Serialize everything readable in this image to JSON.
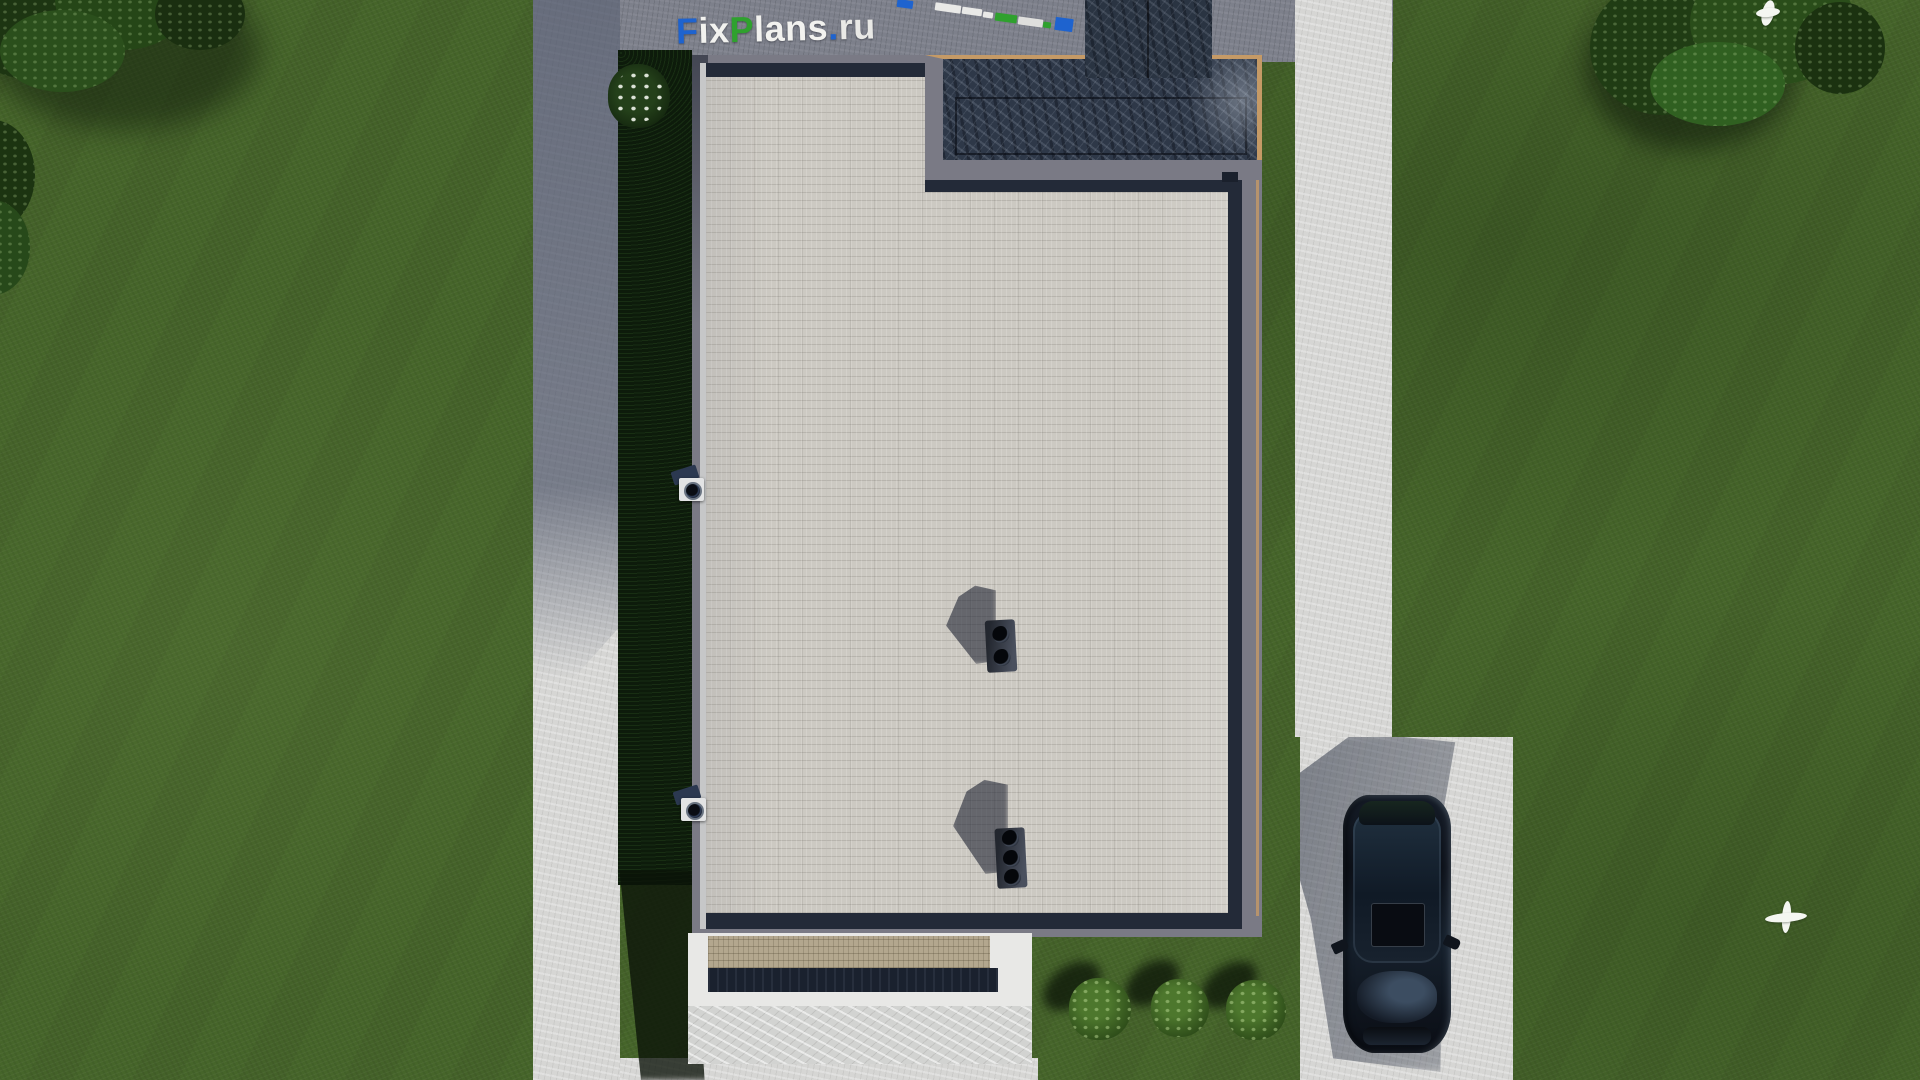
{
  "watermark": {
    "text": "FixPlans.ru",
    "segments": [
      {
        "char": "F",
        "color": "#1e63cf"
      },
      {
        "char": "i",
        "color": "#f2f2ef"
      },
      {
        "char": "x",
        "color": "#f2f2ef"
      },
      {
        "char": "P",
        "color": "#2fa12e"
      },
      {
        "char": "l",
        "color": "#f2f2ef"
      },
      {
        "char": "a",
        "color": "#f2f2ef"
      },
      {
        "char": "n",
        "color": "#f2f2ef"
      },
      {
        "char": "s",
        "color": "#f2f2ef"
      },
      {
        "char": ".",
        "color": "#1e63cf"
      },
      {
        "char": "r",
        "color": "#e9e9e6"
      },
      {
        "char": "u",
        "color": "#e9e9e6"
      }
    ],
    "fragments": [
      {
        "x": 897,
        "y": 0,
        "w": 16,
        "h": 8,
        "color": "#1e63cf"
      },
      {
        "x": 935,
        "y": 4,
        "w": 26,
        "h": 8,
        "color": "#e9e9e7"
      },
      {
        "x": 962,
        "y": 8,
        "w": 20,
        "h": 7,
        "color": "#e9e9e7"
      },
      {
        "x": 983,
        "y": 12,
        "w": 10,
        "h": 6,
        "color": "#e9e9e7"
      },
      {
        "x": 995,
        "y": 14,
        "w": 22,
        "h": 8,
        "color": "#2fa12e"
      },
      {
        "x": 1018,
        "y": 18,
        "w": 25,
        "h": 8,
        "color": "#dfdfdd"
      },
      {
        "x": 1043,
        "y": 22,
        "w": 8,
        "h": 6,
        "color": "#2fa12e"
      },
      {
        "x": 1055,
        "y": 18,
        "w": 18,
        "h": 13,
        "color": "#1e63cf"
      }
    ]
  },
  "palette": {
    "grass": "#46652a",
    "path_concrete": "#d6d6d4",
    "shaded_concrete": "#7d808b",
    "roof_tiles": "#ccc9c2",
    "parapet": "#7a7a85",
    "marble_terrace": "#2e3848",
    "wood_trim": "#c59a66",
    "inner_ring": "#232a38",
    "porch_recess": "#1a212e",
    "car_paint": "#0b0f16",
    "hedge_shadow": "#0d1b0b"
  },
  "scene": {
    "view": "top-down architectural render of a flat-roof house plot",
    "objects": {
      "flat_roof_house": 1,
      "dark_marble_roof_terrace": 1,
      "chimney_block": 1,
      "rooftop_vents": [
        {
          "ports": 2
        },
        {
          "ports": 3
        }
      ],
      "wall_cameras": 2,
      "flowering_bush": 1,
      "round_bushes": 3,
      "trees": 3,
      "parked_car": 1,
      "flying_birds": 2
    }
  }
}
